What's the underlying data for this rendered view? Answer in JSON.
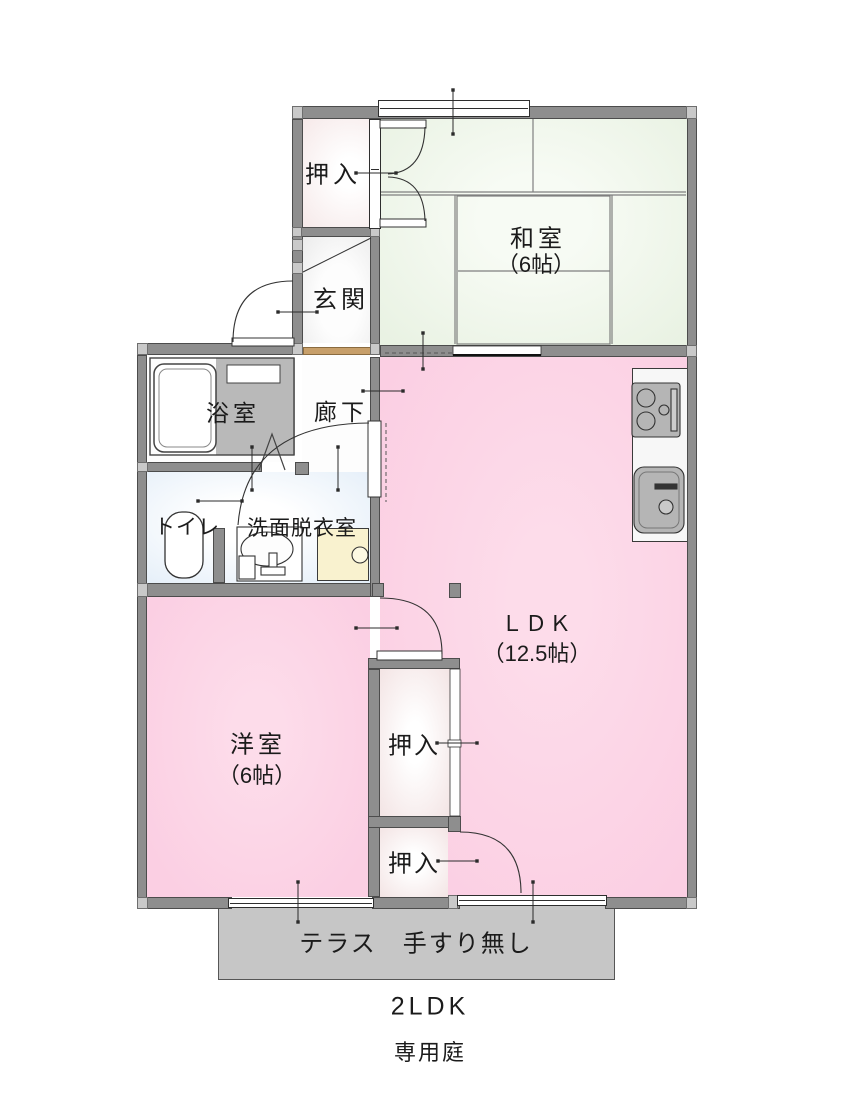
{
  "floorplan": {
    "type_label": "2LDK",
    "garden_label": "専用庭",
    "terrace": {
      "label": "テラス　手すり無し"
    },
    "rooms": {
      "oshiire_top": {
        "label": "押入"
      },
      "genkan": {
        "label": "玄関"
      },
      "washitsu": {
        "label": "和室",
        "size": "（6帖）"
      },
      "bathroom": {
        "label": "浴室"
      },
      "hallway": {
        "label": "廊下"
      },
      "toilet": {
        "label": "トイレ"
      },
      "washroom": {
        "label": "洗面脱衣室"
      },
      "ldk": {
        "label": "ＬＤＫ",
        "size": "（12.5帖）"
      },
      "western_room": {
        "label": "洋室",
        "size": "（6帖）"
      },
      "oshiire_mid": {
        "label": "押入"
      },
      "oshiire_btm": {
        "label": "押入"
      }
    },
    "colors": {
      "room_pink": "#fbcfe3",
      "tatami_green": "#e9f2e3",
      "wall_gray": "#8e8e8e",
      "terrace_gray": "#c6c6c6",
      "wet_area_blue": "#e2edf8",
      "washer_pan_yellow": "#f9f2cf",
      "entry_step_brown": "#c79f6a",
      "closet_pink_white": "#f6e9e9"
    }
  }
}
